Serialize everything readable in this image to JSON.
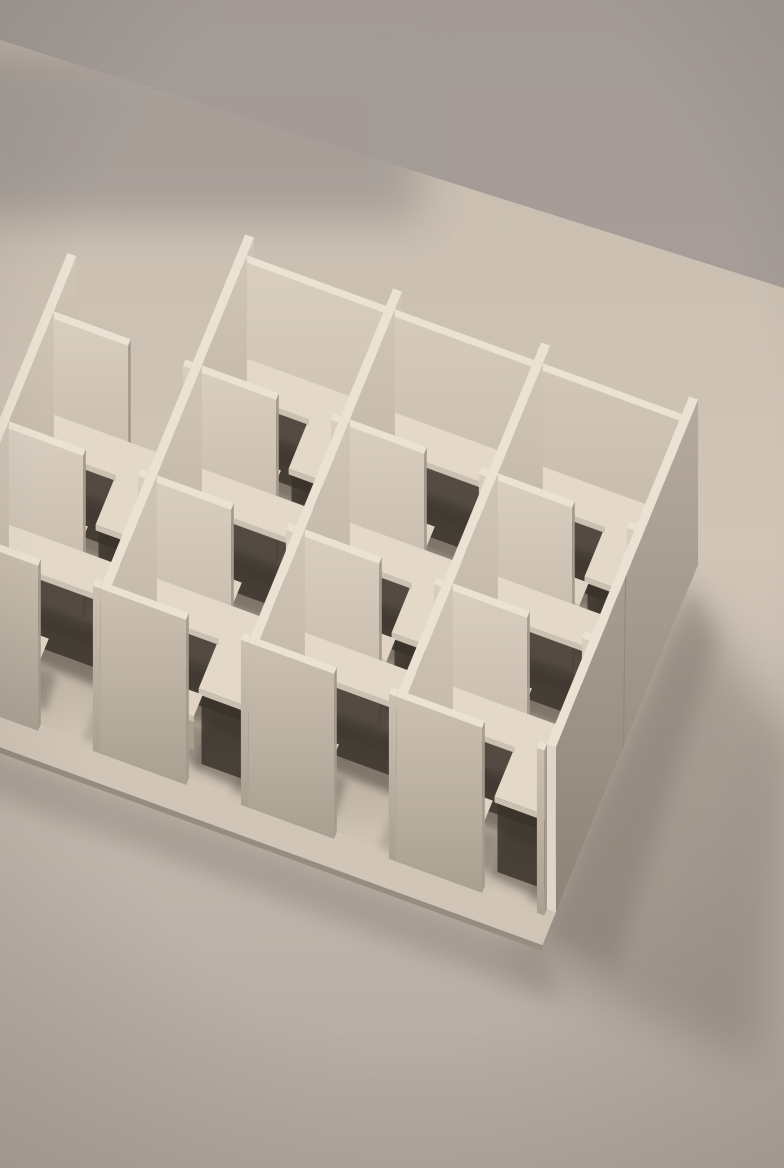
{
  "scene": {
    "description": "Monochrome beige 3D-rendered architectural scale model of a grid of office cubicles, each small room furnished with a minimalist desk with thin frame legs and a simple panel chair, viewed from an elevated isometric angle on a plain warm-grey tabletop with soft studio lighting and a diffuse shadow cast to the lower right.",
    "style": "minimalist clay render",
    "objects": [
      "cubicle partition walls",
      "frame-leg desks",
      "panel chairs",
      "tabletop surface"
    ],
    "grid": {
      "rows": 3,
      "cols": 3,
      "partial_left_column": true
    }
  },
  "palette": {
    "bg_top": "#a49b96",
    "bg_bottom": "#aea49d",
    "surface_top": "#c7bcae",
    "surface_mid": "#d1c5b7",
    "surface_bottom": "#b1a7a0",
    "wall_top": "#ece2d3",
    "u_face_light": "#d9cec0",
    "u_face_dark": "#c3b7a8",
    "v_face_light": "#d1c5b7",
    "v_face_dark": "#bbafa1",
    "front_face_light": "#ccc0b1",
    "front_face_dark": "#aaa092",
    "outer_wall_top": "#b6ab9e",
    "outer_wall_bottom": "#8d8377",
    "cap_dark": "#a59a8c",
    "cap_light": "#e0d6c8",
    "floor_back": "#a89c8e",
    "floor_front": "#d2c6b7",
    "interior_shadow": "#685e53",
    "under_desk_shadow": "#39322a",
    "desk_top": "#e4d9c9",
    "desk_edge": "#cbc0b1",
    "desk_side": "#b4a99b",
    "desk_leg": "#a79d90",
    "chair_face": "#d6cbbd",
    "chair_side": "#ab9f91",
    "chair_seat": "#e0d5c5",
    "cast_shadow": "#7e756c",
    "plinth_edge": "#978c80",
    "vignette": "rgba(58,50,43,0.16)"
  },
  "render": {
    "canvas": [
      784,
      1168
    ],
    "origin": [
      238,
      252
    ],
    "u": [
      148,
      54
    ],
    "v": [
      -45,
      110
    ],
    "wall_height": 165,
    "wall_thickness": 0.06,
    "door_gap": [
      0.58,
      0.95
    ],
    "desk_height": 0.45,
    "desk_slab": 0.035,
    "chair_seat_height": 0.2,
    "chair_back_height": 0.52,
    "table_edge": [
      [
        348,
        150
      ],
      [
        784,
        288
      ]
    ]
  }
}
